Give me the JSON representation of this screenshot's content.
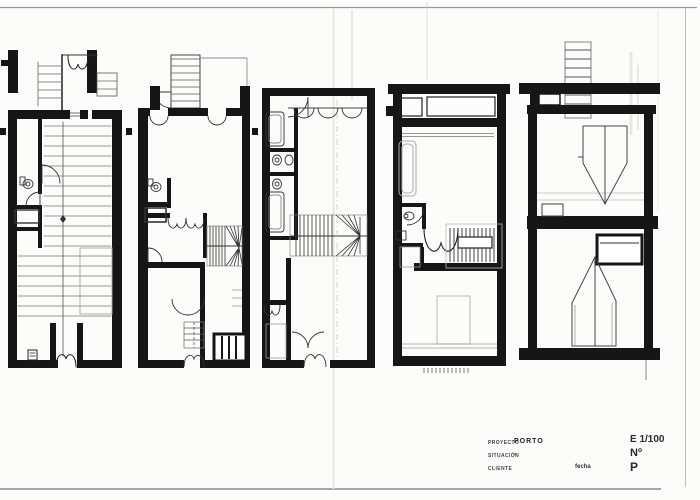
{
  "title_block": {
    "project_label": "PROYECTO",
    "project_value": "PORTO",
    "situation_label": "SITUACIÓN",
    "situation_value": "-",
    "client_label": "CLIENTE",
    "client_value": "",
    "date_label": "fecha",
    "scale": "E 1/100",
    "sheet_number_label": "Nº",
    "sheet_letter": "P"
  },
  "colors": {
    "paper": "#fcfcfa",
    "ink": "#161616",
    "light_line": "#9a9a9a",
    "fold_line": "#e6e6e2"
  }
}
